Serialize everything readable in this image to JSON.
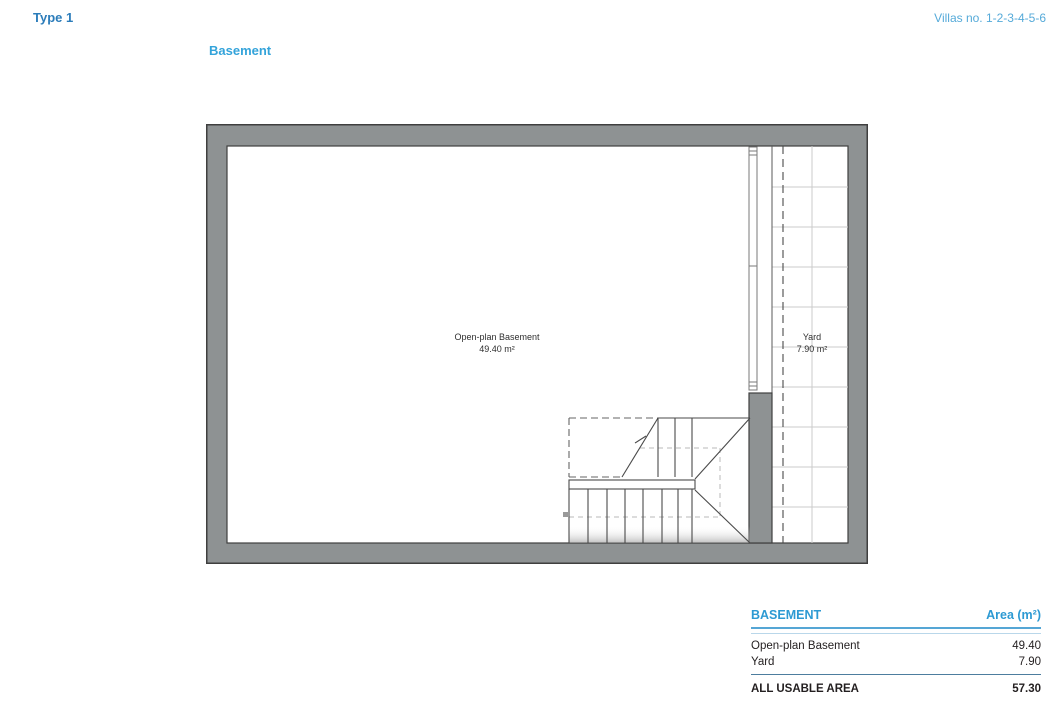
{
  "header": {
    "type_label": "Type 1",
    "villas_label": "Villas no. 1-2-3-4-5-6",
    "floor_title": "Basement"
  },
  "plan": {
    "rooms": [
      {
        "name": "Open-plan Basement",
        "area": "49.40 m²"
      },
      {
        "name": "Yard",
        "area": "7.90 m²"
      }
    ]
  },
  "table": {
    "title": "BASEMENT",
    "area_column": "Area (m²)",
    "rows": [
      {
        "label": "Open-plan Basement",
        "value": "49.40"
      },
      {
        "label": "Yard",
        "value": "7.90"
      }
    ],
    "total": {
      "label": "ALL USABLE AREA",
      "value": "57.30"
    }
  },
  "colors": {
    "type_label_blue": "#2b7cba",
    "villas_blue": "#55aad9",
    "floor_title_blue": "#33a3da",
    "table_header_blue": "#2d9ad3",
    "header_rule_blue": "#55a6d5",
    "thin_rule_blue": "#b9d7ea",
    "total_rule_blue": "#4d7d9e",
    "wall_gray": "#8e9293",
    "wall_outline": "#3f3f3f",
    "text_dark": "#231f20"
  }
}
